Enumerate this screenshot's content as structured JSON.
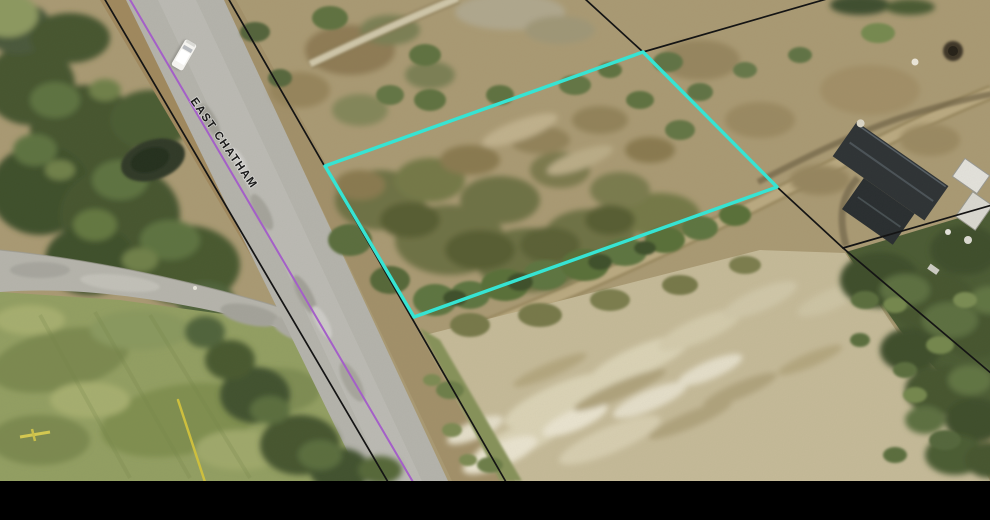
{
  "road": {
    "label": "EAST CHATHAM"
  },
  "overlay": {
    "highlight_color": "#36e4d3",
    "parcel_line_color": "#141414",
    "purple_line_color": "#a45fc8",
    "yellow_line_color": "#cdbf3e",
    "selected_parcel_points": "643,52 777,187 414,317 325,166",
    "parcel_lines": [
      {
        "name": "road-west-boundary",
        "d": "M104,-2 L388,482"
      },
      {
        "name": "road-east-boundary",
        "d": "M228,-2 L506,482"
      },
      {
        "name": "north-parcel-line",
        "d": "M584,-2 L643,52"
      },
      {
        "name": "northeast-parcel-line",
        "d": "M643,52 L830,-2"
      },
      {
        "name": "east-parcel-line",
        "d": "M777,187 L843,248"
      },
      {
        "name": "east-upper-split",
        "d": "M843,248 L992,205"
      },
      {
        "name": "east-lower-split",
        "d": "M843,248 L992,374"
      }
    ],
    "purple_line_d": "M129,-2 L413,482",
    "yellow_line_d": "M178,400 L205,482"
  },
  "letterbox_color": "#000000"
}
